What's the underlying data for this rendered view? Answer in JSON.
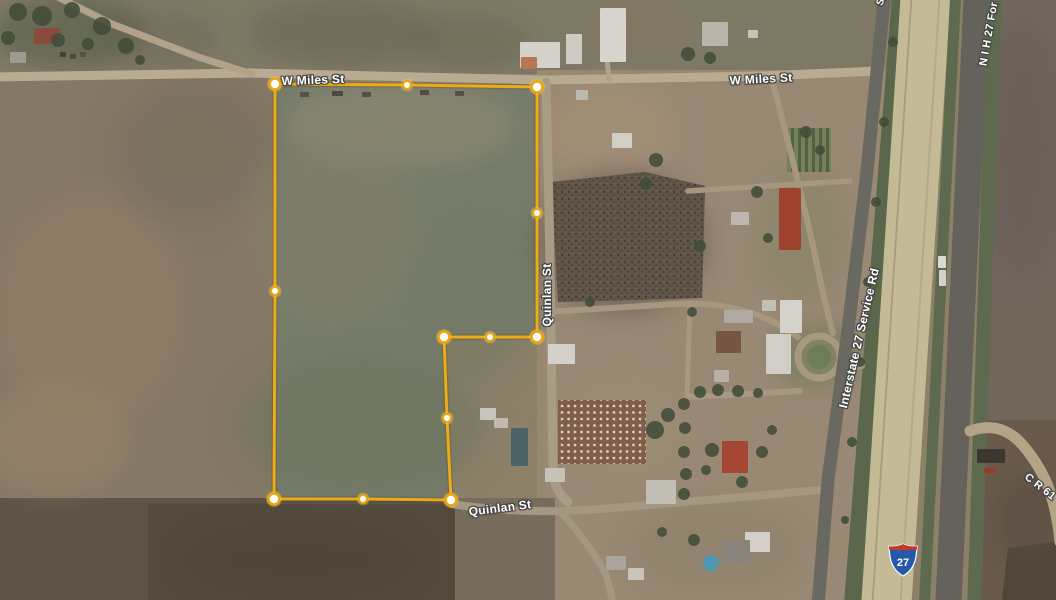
{
  "map": {
    "type": "satellite-imagery",
    "labels": [
      {
        "id": "street-label-w-miles-st-west",
        "text": "W Miles St",
        "x": 313,
        "y": 80,
        "rot": -2,
        "size": 12
      },
      {
        "id": "street-label-w-miles-st-east",
        "text": "W Miles St",
        "x": 761,
        "y": 79,
        "rot": -3,
        "size": 12
      },
      {
        "id": "street-label-quinlan-st-vertical",
        "text": "Quinlan St",
        "x": 547,
        "y": 295,
        "rot": -90,
        "size": 12
      },
      {
        "id": "street-label-quinlan-st-south",
        "text": "Quinlan St",
        "x": 500,
        "y": 508,
        "rot": -7,
        "size": 12
      },
      {
        "id": "street-label-interstate-27-service-rd",
        "text": "Interstate 27 Service Rd",
        "x": 859,
        "y": 338,
        "rot": -77,
        "size": 12
      },
      {
        "id": "street-label-n-i-h-27-frontage",
        "text": "N I H 27 For",
        "x": 989,
        "y": 34,
        "rot": -80,
        "size": 11
      },
      {
        "id": "street-label-c-r-61",
        "text": "C R 61",
        "x": 1040,
        "y": 487,
        "rot": 38,
        "size": 11
      },
      {
        "id": "street-label-partial-s",
        "text": "S",
        "x": 881,
        "y": 2,
        "rot": -70,
        "size": 10
      }
    ],
    "shield": {
      "route": "27",
      "x": 888,
      "y": 543
    },
    "boundary": {
      "stroke_color": "#f3ae14",
      "vertex_fill": "#ffffff",
      "vertex_ring": "#eba60f",
      "vertices": [
        {
          "x": 275,
          "y": 84,
          "r": 5.5
        },
        {
          "x": 407,
          "y": 85,
          "r": 4
        },
        {
          "x": 537,
          "y": 87,
          "r": 5.5
        },
        {
          "x": 537,
          "y": 213,
          "r": 4
        },
        {
          "x": 537,
          "y": 337,
          "r": 5.5
        },
        {
          "x": 490,
          "y": 337,
          "r": 4
        },
        {
          "x": 444,
          "y": 337,
          "r": 5.5
        },
        {
          "x": 447,
          "y": 418,
          "r": 4
        },
        {
          "x": 451,
          "y": 500,
          "r": 5.5
        },
        {
          "x": 363,
          "y": 499,
          "r": 4
        },
        {
          "x": 274,
          "y": 499,
          "r": 5.5
        },
        {
          "x": 275,
          "y": 291,
          "r": 4
        }
      ]
    },
    "colors": {
      "field_base": "#95886f",
      "parcel_interior": "#7c8370",
      "plowed_dark": "#52473b",
      "highway_pavement": "#d8cca3",
      "asphalt": "#66655d",
      "median_green": "#5f6e4e",
      "dirt_road": "#c9ba9d",
      "boundary_gold": "#f3ae14",
      "shield_blue": "#2458ad",
      "shield_red": "#c0392b"
    }
  },
  "scene": {
    "fields": [
      {
        "r": [
          0,
          0,
          1056,
          600
        ],
        "c": "#95886f"
      },
      {
        "r": [
          0,
          0,
          882,
          74
        ],
        "c": "#84806a"
      },
      {
        "r": [
          0,
          70,
          276,
          436
        ],
        "c": "#8d7f6a"
      },
      {
        "r": [
          537,
          70,
          350,
          535
        ],
        "c": "#a3917b"
      },
      {
        "r": [
          0,
          498,
          462,
          102
        ],
        "c": "#5d5346"
      },
      {
        "r": [
          148,
          504,
          312,
          96
        ],
        "c": "#52473b"
      },
      {
        "r": [
          455,
          498,
          100,
          102
        ],
        "c": "#7c7260"
      },
      {
        "p": "1000,0 1056,0 1056,430 986,430",
        "c": "#746960"
      },
      {
        "p": "986,420 1056,420 1056,600 980,600",
        "c": "#6b5a4b"
      },
      {
        "p": "1008,548 1056,542 1056,600 1002,600",
        "c": "#4d4437"
      },
      {
        "p": "275,84 407,85 537,87 537,213 537,337 490,337 444,337 447,418 451,500 363,499 274,499 275,291",
        "c": "#7c8370"
      }
    ],
    "patches": [
      [
        90,
        310,
        95,
        115,
        "#a2846d",
        0.55,
        12
      ],
      [
        55,
        440,
        75,
        55,
        "#a98c72",
        0.5,
        12
      ],
      [
        195,
        150,
        85,
        75,
        "#7b7160",
        0.5,
        14
      ],
      [
        345,
        32,
        95,
        32,
        "#6e6c57",
        0.6,
        10
      ],
      [
        470,
        42,
        60,
        26,
        "#6e6c57",
        0.5,
        10
      ],
      [
        150,
        38,
        70,
        26,
        "#756e5a",
        0.5,
        10
      ],
      [
        640,
        30,
        60,
        30,
        "#8d8068",
        0.5,
        12
      ],
      [
        400,
        125,
        115,
        42,
        "#a0987d",
        0.5,
        12
      ],
      [
        330,
        225,
        85,
        95,
        "#8f8a72",
        0.4,
        14
      ],
      [
        360,
        425,
        125,
        70,
        "#6d7960",
        0.5,
        14
      ],
      [
        475,
        300,
        60,
        85,
        "#747f68",
        0.45,
        12
      ],
      [
        610,
        130,
        65,
        48,
        "#b89e81",
        0.55,
        12
      ],
      [
        625,
        425,
        65,
        52,
        "#ad9a7e",
        0.5,
        12
      ],
      [
        818,
        356,
        45,
        32,
        "#73845b",
        0.55,
        8
      ],
      [
        800,
        235,
        42,
        65,
        "#898c67",
        0.45,
        10
      ],
      [
        622,
        242,
        85,
        72,
        "#5a4f44",
        0.5,
        12
      ],
      [
        715,
        548,
        85,
        42,
        "#92856c",
        0.45,
        12
      ],
      [
        1022,
        150,
        42,
        125,
        "#6a5f58",
        0.5,
        12
      ],
      [
        1028,
        520,
        32,
        42,
        "#594b3f",
        0.55,
        10
      ],
      [
        70,
        32,
        75,
        35,
        "#57624a",
        0.55,
        9
      ],
      [
        300,
        560,
        120,
        40,
        "#4a4136",
        0.5,
        12
      ]
    ],
    "zones": [
      {
        "p": "552,182 645,172 705,186 702,298 558,302",
        "c": "#675a4e",
        "o": 0.9
      },
      {
        "p": "552,182 645,172 705,186 702,298 558,302",
        "c": "url(#speckle)",
        "o": 0.85
      },
      {
        "r": [
          558,
          400,
          88,
          64
        ],
        "c": "url(#dots)",
        "o": 1
      },
      {
        "r": [
          787,
          128,
          44,
          44
        ],
        "c": "url(#stripes)",
        "o": 0.9
      },
      {
        "ci": [
          819,
          357,
          12
        ],
        "c": "#72835a",
        "o": 1
      },
      {
        "ci": [
          711,
          563,
          8
        ],
        "c": "#4da0c4",
        "o": 1
      }
    ],
    "bands": [
      {
        "d": "M901 -10 L852 610",
        "w": 17,
        "c": "#5c6b4b"
      },
      {
        "d": "M926 -10 L886 610",
        "w": 50,
        "c": "#d8cca3"
      },
      {
        "d": "M912 -10 L872 610",
        "w": 2,
        "c": "#b8ab84"
      },
      {
        "d": "M940 -10 L900 610",
        "w": 2,
        "c": "#c4b78f"
      },
      {
        "d": "M956 -12 L924 612",
        "w": 11,
        "c": "#5f6e4e"
      },
      {
        "d": "M977 -12 L948 612",
        "w": 26,
        "c": "#66655d"
      },
      {
        "d": "M995 -12 L974 612",
        "w": 14,
        "c": "#5f6e4e"
      }
    ],
    "roads": [
      {
        "d": "M-6 77 L250 73 L545 80 L761 76 L878 71",
        "w": 9,
        "c": "#c9ba9d"
      },
      {
        "d": "M52 -6 L112 24 L198 57 L252 74",
        "w": 7,
        "c": "#c0b094"
      },
      {
        "d": "M546 82 L549 210 L551 336 L553 472 Q555 492 568 502",
        "w": 9,
        "c": "#b6a98f"
      },
      {
        "d": "M452 504 Q520 515 600 509 Q700 501 830 489",
        "w": 8,
        "c": "#b3a489"
      },
      {
        "d": "M560 511 Q588 542 606 574 L613 602",
        "w": 7,
        "c": "#b3a489"
      },
      {
        "d": "M546 312 L660 305 Q745 297 798 337",
        "w": 6,
        "c": "#b6a388"
      },
      {
        "d": "M772 80 Q792 155 813 245 Q822 292 833 333",
        "w": 6,
        "c": "#b6a388"
      },
      {
        "d": "M688 191 L850 181",
        "w": 5.5,
        "c": "#b6a388"
      },
      {
        "cx": 819,
        "cy": 357,
        "r": 21,
        "w": 7,
        "c": "#b4a58a"
      },
      {
        "d": "M838 371 L862 366",
        "w": 6,
        "c": "#b4a58a"
      },
      {
        "d": "M688 397 L800 391",
        "w": 6,
        "c": "#b4a58a"
      },
      {
        "d": "M690 303 L687 397",
        "w": 5,
        "c": "#b4a58a"
      },
      {
        "d": "M609 80 L606 48",
        "w": 5,
        "c": "#c0b094"
      },
      {
        "d": "M885 -8 L866 180 L848 330 L828 480 L818 606",
        "w": 13,
        "c": "#6e6d65"
      },
      {
        "d": "M970 431 Q1003 419 1026 449 Q1046 474 1053 502 Q1058 520 1060 542",
        "w": 11,
        "c": "#c3b293"
      }
    ],
    "buildings": [
      [
        520,
        42,
        40,
        26,
        "#e9e7e1"
      ],
      [
        521,
        57,
        16,
        12,
        "#c67e55"
      ],
      [
        566,
        34,
        16,
        30,
        "#e3e0d9"
      ],
      [
        600,
        8,
        26,
        54,
        "#edebe5"
      ],
      [
        702,
        22,
        26,
        24,
        "#c9c4bc"
      ],
      [
        748,
        30,
        10,
        8,
        "#d9d6ce"
      ],
      [
        612,
        133,
        20,
        15,
        "#e6e3db"
      ],
      [
        576,
        90,
        12,
        10,
        "#d0cbc0"
      ],
      [
        300,
        92,
        9,
        5,
        "#554f48"
      ],
      [
        332,
        91,
        11,
        5,
        "#4c463f"
      ],
      [
        362,
        92,
        9,
        5,
        "#554f48"
      ],
      [
        420,
        90,
        9,
        5,
        "#504a43"
      ],
      [
        455,
        91,
        9,
        5,
        "#554f48"
      ],
      [
        779,
        188,
        22,
        62,
        "#ad3f2c"
      ],
      [
        731,
        212,
        18,
        13,
        "#cdc9c1"
      ],
      [
        762,
        300,
        14,
        11,
        "#d6d3cb"
      ],
      [
        780,
        300,
        22,
        33,
        "#eae8e2"
      ],
      [
        766,
        334,
        25,
        40,
        "#e5e3dc"
      ],
      [
        724,
        310,
        29,
        13,
        "#beb9b1"
      ],
      [
        716,
        331,
        25,
        22,
        "#7d5546"
      ],
      [
        714,
        370,
        15,
        12,
        "#c6c1b9"
      ],
      [
        548,
        344,
        27,
        20,
        "#e7e5de"
      ],
      [
        480,
        408,
        16,
        12,
        "#ddd9d1"
      ],
      [
        494,
        418,
        14,
        10,
        "#d0ccc4"
      ],
      [
        511,
        428,
        17,
        38,
        "#4c666d"
      ],
      [
        545,
        468,
        20,
        14,
        "#d9d5cd"
      ],
      [
        722,
        441,
        26,
        32,
        "#b24530"
      ],
      [
        745,
        532,
        25,
        20,
        "#e7e5df"
      ],
      [
        722,
        540,
        28,
        24,
        "#918c84"
      ],
      [
        646,
        480,
        30,
        24,
        "#d3d0c8"
      ],
      [
        606,
        556,
        20,
        14,
        "#b7b2aa"
      ],
      [
        628,
        568,
        16,
        12,
        "#ddd9d1"
      ],
      [
        34,
        28,
        26,
        16,
        "#93493a"
      ],
      [
        10,
        52,
        16,
        11,
        "#aba59c"
      ],
      [
        60,
        52,
        6,
        5,
        "#403b36"
      ],
      [
        70,
        54,
        6,
        5,
        "#4b453f"
      ],
      [
        80,
        52,
        6,
        5,
        "#56514b"
      ],
      [
        977,
        449,
        28,
        14,
        "#36312b"
      ],
      [
        984,
        468,
        13,
        5,
        "#a03828"
      ],
      [
        938,
        256,
        8,
        12,
        "#f3f1eb"
      ],
      [
        939,
        270,
        7,
        16,
        "#e9e7e1"
      ]
    ],
    "trees": [
      [
        18,
        12,
        9
      ],
      [
        42,
        16,
        10
      ],
      [
        72,
        10,
        8
      ],
      [
        102,
        26,
        9
      ],
      [
        126,
        46,
        8
      ],
      [
        8,
        38,
        7
      ],
      [
        58,
        40,
        7
      ],
      [
        88,
        44,
        6
      ],
      [
        140,
        60,
        5
      ],
      [
        688,
        54,
        7
      ],
      [
        710,
        58,
        6
      ],
      [
        656,
        160,
        7
      ],
      [
        646,
        184,
        6
      ],
      [
        700,
        246,
        6
      ],
      [
        692,
        312,
        5
      ],
      [
        757,
        192,
        6
      ],
      [
        768,
        238,
        5
      ],
      [
        700,
        392,
        6
      ],
      [
        718,
        390,
        6
      ],
      [
        738,
        391,
        6
      ],
      [
        758,
        393,
        5
      ],
      [
        684,
        404,
        6
      ],
      [
        685,
        428,
        6
      ],
      [
        684,
        452,
        6
      ],
      [
        686,
        474,
        6
      ],
      [
        684,
        494,
        6
      ],
      [
        712,
        450,
        7
      ],
      [
        762,
        452,
        6
      ],
      [
        742,
        482,
        6
      ],
      [
        706,
        470,
        5
      ],
      [
        772,
        430,
        5
      ],
      [
        694,
        540,
        6
      ],
      [
        662,
        532,
        5
      ],
      [
        590,
        302,
        5
      ],
      [
        893,
        42,
        5
      ],
      [
        884,
        122,
        5
      ],
      [
        876,
        202,
        5
      ],
      [
        868,
        282,
        5
      ],
      [
        860,
        362,
        5
      ],
      [
        852,
        442,
        5
      ],
      [
        845,
        520,
        4
      ],
      [
        655,
        430,
        9
      ],
      [
        668,
        415,
        7
      ],
      [
        806,
        132,
        6
      ],
      [
        820,
        150,
        5
      ]
    ]
  }
}
